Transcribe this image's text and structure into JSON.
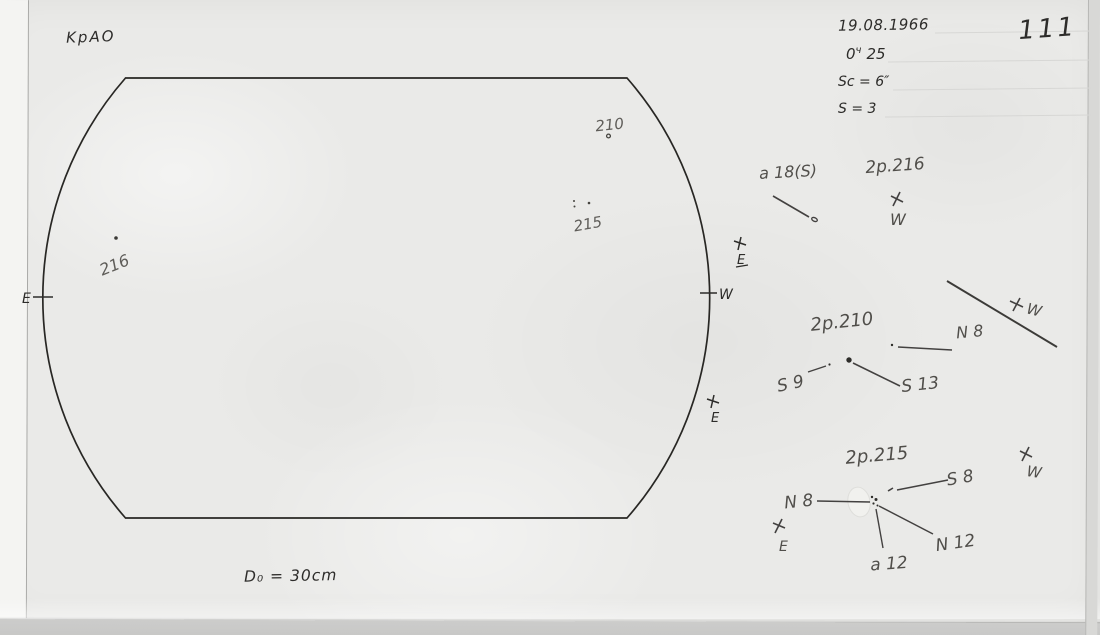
{
  "page": {
    "observatory": "KpAO",
    "date": "19.08.1966",
    "time_hour": "0",
    "time_unit": "ч",
    "time_min": "25",
    "sc": "Sc = 6″",
    "s": "S = 3",
    "page_number": "111",
    "aperture": "D₀ = 30cm"
  },
  "disk": {
    "east": "E",
    "west": "W",
    "spots": {
      "s210": "210",
      "s215": "215",
      "s216": "216"
    },
    "limb_marks": {
      "upper_e": "E",
      "lower_e": "E"
    }
  },
  "sketches": {
    "g216": {
      "label_a": "a 18(S)",
      "label_b": "2p.216",
      "west": "W"
    },
    "g210": {
      "title": "2p.210",
      "north": "N 8",
      "south_a": "S 9",
      "south_b": "S 13",
      "west": "W"
    },
    "g215": {
      "title": "2p.215",
      "south": "S 8",
      "north_a": "N 8",
      "north_b": "N 12",
      "area": "a 12",
      "west": "W",
      "east": "E"
    }
  },
  "colors": {
    "paper": "#eaeae8",
    "ink": "#2d2c2a",
    "pencil": "#504e4a"
  }
}
